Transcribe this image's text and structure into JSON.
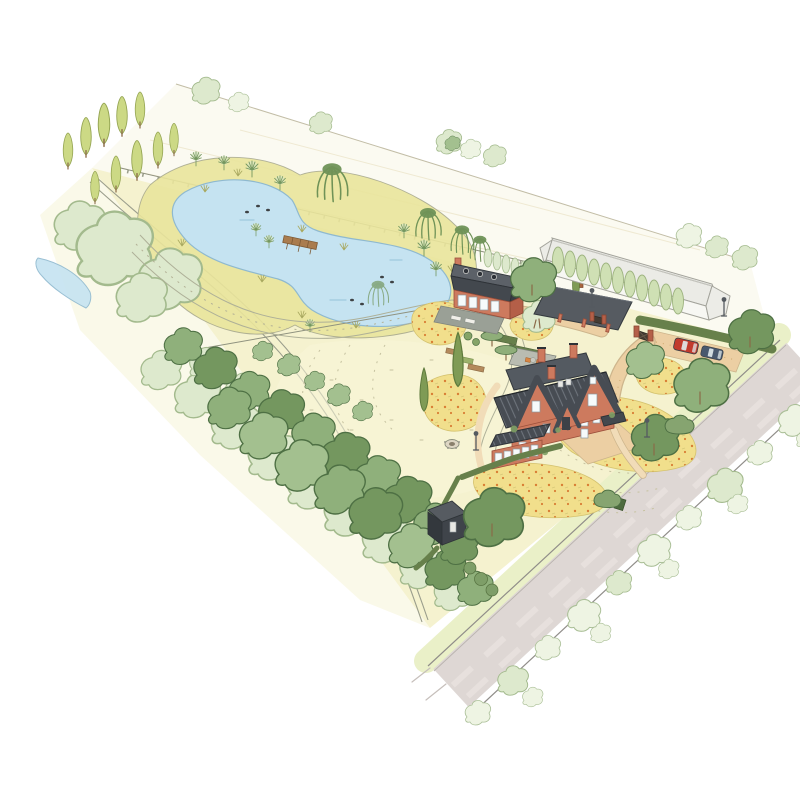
{
  "palette": {
    "paper": "#ffffff",
    "far_field": "#fbfaf1",
    "field": "#f5f2cf",
    "lawn": "#f8f6d8",
    "meadow": "#f1df8c",
    "flower_dot": "#d97e35",
    "pond": "#c5e3f1",
    "pond_edge": "#8fb9cf",
    "stream": "#c5e3f1",
    "reed": "#e9e49b",
    "tree": "#8fb07b",
    "tree_dark": "#74975f",
    "tree_line": "#4e7044",
    "tree_soft": "#dde9cd",
    "tree_soft_line": "#a3ba8d",
    "poplar": "#ccd985",
    "poplar_line": "#95a553",
    "conifer": "#cfe0b4",
    "willow": "#6f9257",
    "hedge": "#67804b",
    "brick": "#cd7a5e",
    "brick_dark": "#b45f48",
    "roof": "#474c53",
    "roof_light": "#6d737b",
    "white_wall": "#f7f7f3",
    "white_roof": "#ebebe6",
    "barn": "#565b61",
    "barn_shadow": "#3c4147",
    "terrace": "#9aa096",
    "path": "#f1dcb8",
    "drive": "#eccfa3",
    "road": "#ded7d4",
    "road_line": "#908d89",
    "verge": "#eaf0c8",
    "car_red": "#c23a2d",
    "car_blue": "#49596e",
    "wood": "#aa7c4e",
    "fence": "#8f927f",
    "duck": "#3e4245",
    "furniture": "#d98643",
    "outline": "#8b8f7d"
  },
  "scene": {
    "title": "Hand-drawn aerial landscape plan of a country property",
    "far_field": "Neighbouring field with sketched hedgerow",
    "pond": "Kidney-shaped natural swimming pond with jetty and ducks",
    "stream": "Stream bend at the west edge",
    "poplars": "Row of columnar poplars",
    "corner_wood": "Soft woodland mass in the north-west corner",
    "woodland": "Woodland belt along the south-west boundary",
    "lawn": "Mown lawn with dashed mowing lines and grass paths",
    "meadows": "Wildflower meadow patches with orange blooms",
    "garden": "Formal garden with clipped hedges, beds, terraces, fire pit and lamps",
    "main_house": "Red-brick main house with slate roofs, gables and conservatory",
    "guest_house": "Red-brick guest house with dark mansard roof, dormers and sun terrace",
    "barn": "Dark timber carport barn on brick posts",
    "greenhouse": "Long white neighbouring greenhouse building",
    "conifers": "Columnar conifer screen",
    "shed": "Dark garden shed at the road corner",
    "hedges": "Dark clipped boundary hedges",
    "gate": "Brick gate pillars with dark timber gates",
    "driveway": "Gravel driveway, forecourt and parking court",
    "cars": "Two parked cars - red and dark blue",
    "road": "Country road with grass verge",
    "hedgerow": "Sketched hedgerow on the far side of the road",
    "ducks_count": 7,
    "cars_count": 2
  }
}
